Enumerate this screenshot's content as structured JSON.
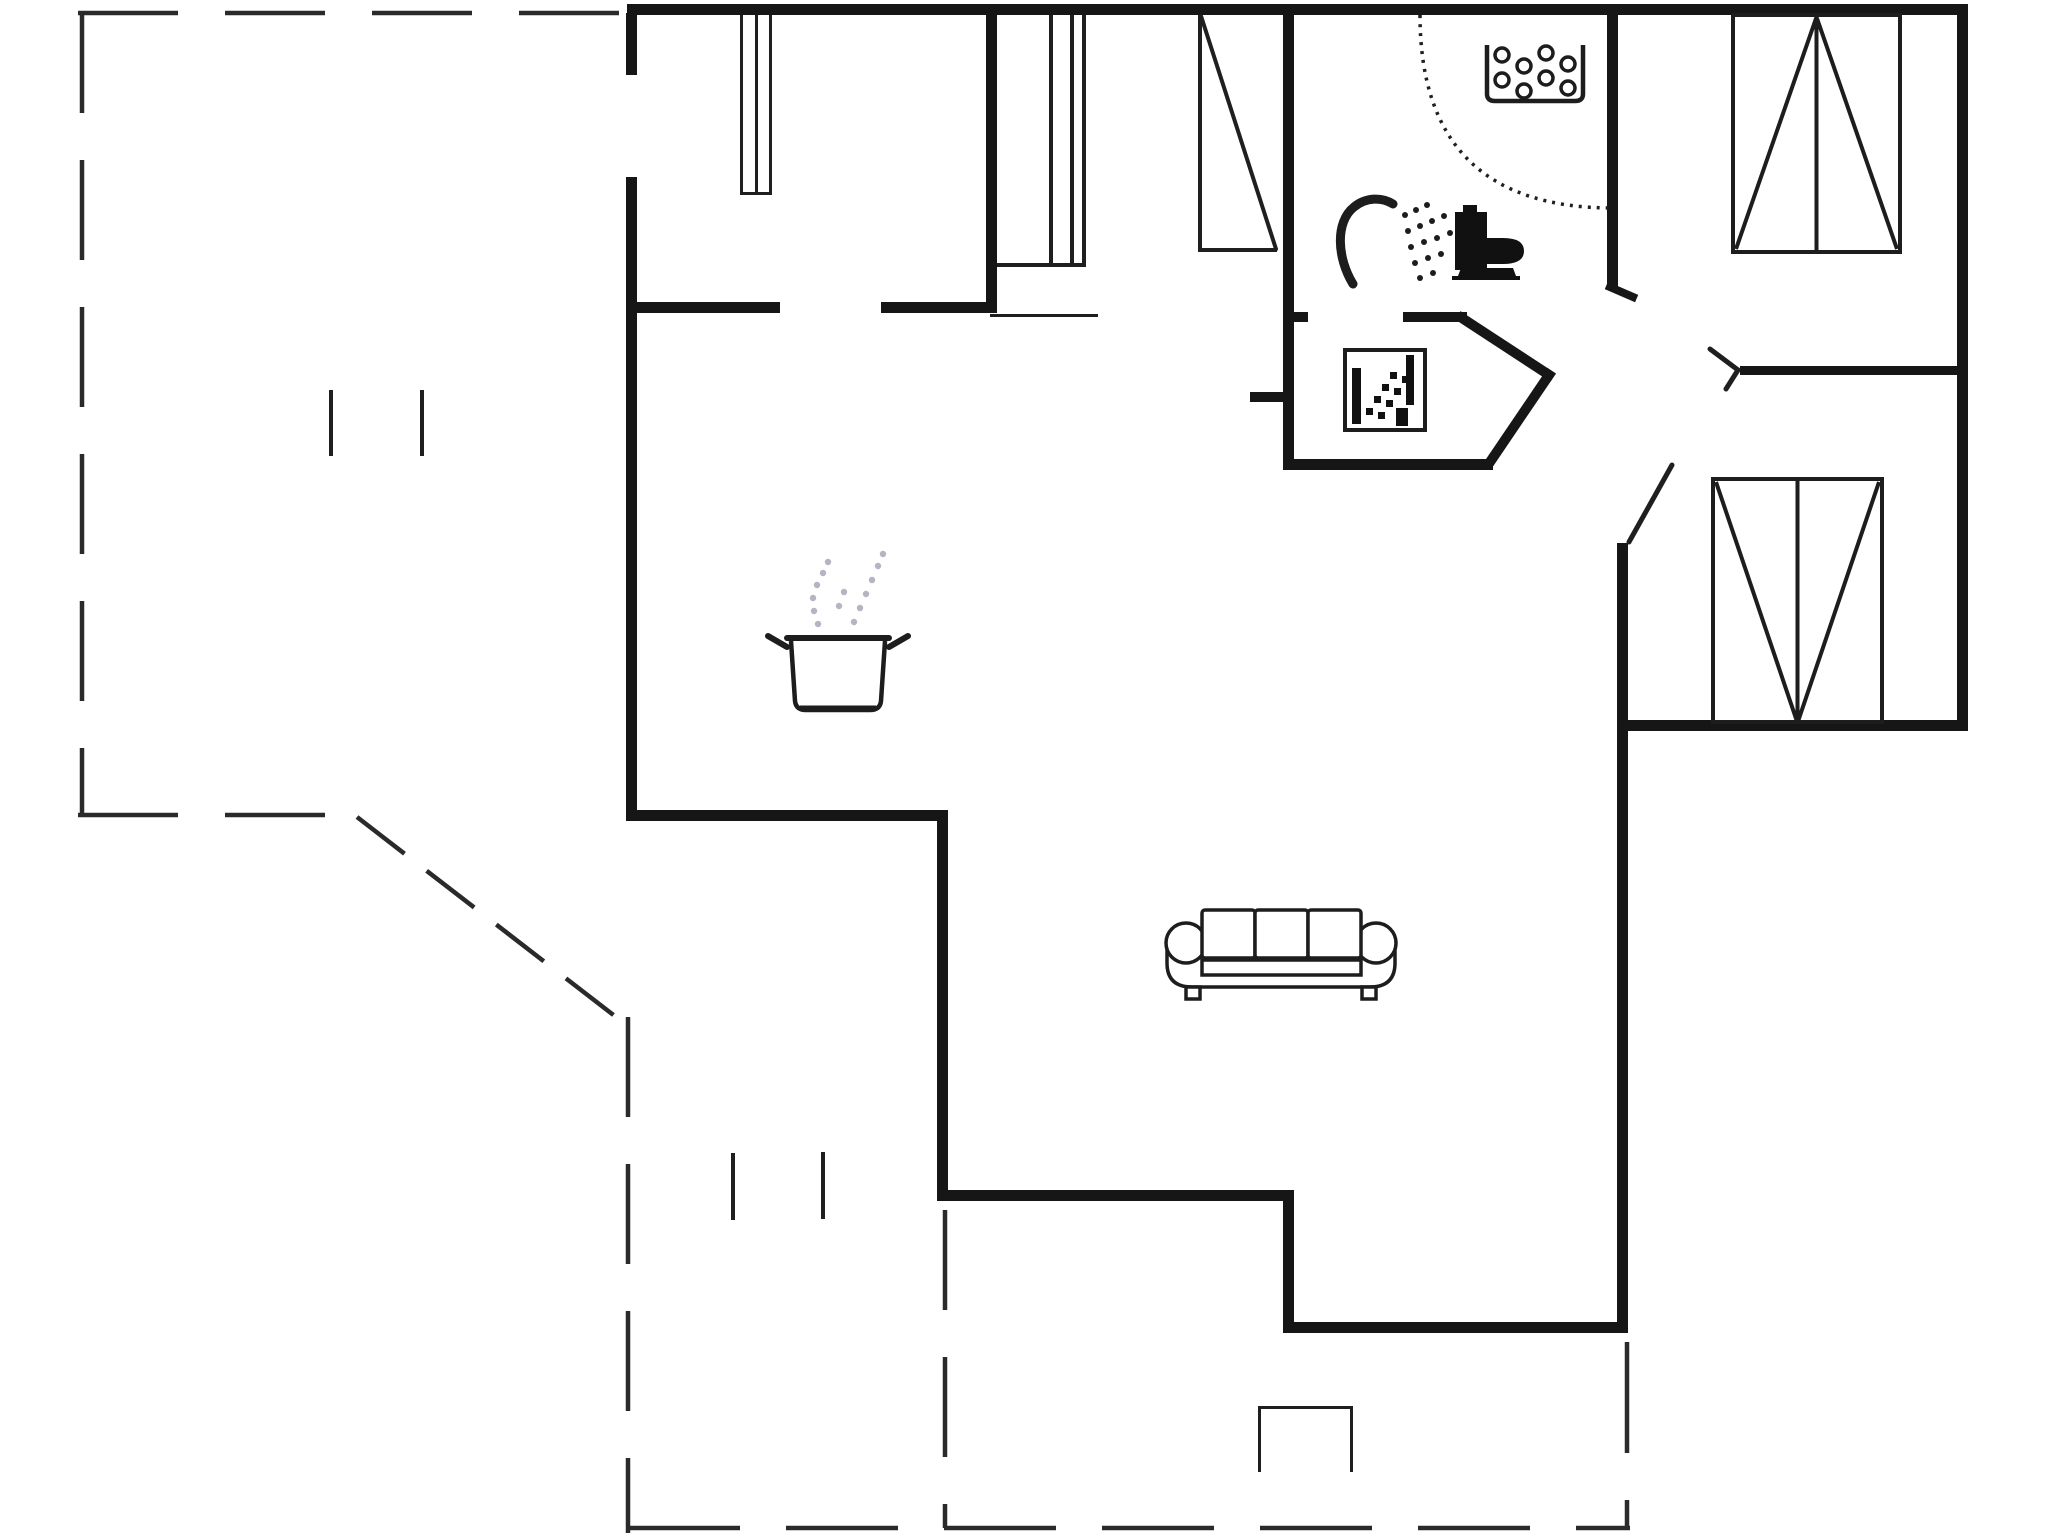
{
  "meta": {
    "title": "holiday-house-floor-plan",
    "canvas": {
      "w": 2048,
      "h": 1536
    },
    "colors": {
      "background": "#ffffff",
      "wall": "#161616",
      "thin": "#1f1f1f",
      "dash": "#2a2a2a",
      "icon": "#1d1d1d",
      "fill_black": "#111111",
      "steam": "#b4b4c2"
    }
  },
  "plan": {
    "walls": [
      [
        627,
        4,
        1341,
        11,
        "top-exterior-wall"
      ],
      [
        1957,
        4,
        11,
        727,
        "right-exterior-wall"
      ],
      [
        1627,
        720,
        341,
        11,
        "bedroom2-bottom-exterior-wall"
      ],
      [
        1617,
        543,
        11,
        790,
        "living-right-exterior-wall"
      ],
      [
        1283,
        1322,
        345,
        11,
        "living-bottom-exterior-wall"
      ],
      [
        1283,
        1196,
        11,
        137,
        "living-left-lower-exterior-wall"
      ],
      [
        948,
        1190,
        346,
        11,
        "living-bottomleft-exterior-wall"
      ],
      [
        937,
        816,
        11,
        385,
        "living-left-exterior-wall"
      ],
      [
        626,
        810,
        322,
        11,
        "kitchen-bottom-exterior-wall"
      ],
      [
        626,
        177,
        11,
        644,
        "kitchen-left-exterior-wall"
      ],
      [
        626,
        13,
        11,
        62,
        "kitchen-left-wall-stub"
      ],
      [
        637,
        302,
        143,
        11,
        "kitchen-partition-wall-left"
      ],
      [
        881,
        302,
        109,
        11,
        "kitchen-partition-wall-right"
      ],
      [
        986,
        13,
        11,
        300,
        "entry-partition-wall"
      ],
      [
        1283,
        13,
        11,
        457,
        "bathroom-left-wall"
      ],
      [
        1283,
        459,
        210,
        11,
        "bathroom-bottom-wall"
      ],
      [
        1607,
        13,
        11,
        275,
        "bathroom-right-wall"
      ],
      [
        1403,
        312,
        64,
        10,
        "bathroom-door-stub"
      ],
      [
        1288,
        312,
        20,
        10,
        "hall-niche-stub-upper"
      ],
      [
        1250,
        392,
        33,
        10,
        "hall-niche-stub-lower"
      ],
      [
        1740,
        366,
        217,
        9,
        "bedroom-divider-wall"
      ]
    ],
    "wall_diagonals": [
      [
        1462,
        318,
        1549,
        375,
        10,
        "hall-chamfer-wall-upper"
      ],
      [
        1549,
        375,
        1490,
        462,
        10,
        "hall-chamfer-wall-lower"
      ],
      [
        1610,
        287,
        1633,
        297,
        8,
        "bathroom-right-wall-end-stub"
      ]
    ],
    "thin_rects": [
      [
        1198,
        15,
        4,
        237,
        "entrance-door-edge"
      ],
      [
        1199,
        248,
        78,
        4,
        "entrance-door-bottom"
      ],
      [
        997,
        263,
        89,
        4,
        "entry-cupboard-bottom"
      ],
      [
        1082,
        15,
        4,
        252,
        "entry-cupboard-right"
      ],
      [
        1049,
        15,
        4,
        252,
        "entry-cupboard-inner-a"
      ],
      [
        1070,
        15,
        4,
        252,
        "entry-cupboard-inner-b"
      ],
      [
        990,
        314,
        108,
        3,
        "entry-threshold-line"
      ],
      [
        740,
        15,
        3,
        179,
        "room-cupboard-left"
      ],
      [
        769,
        15,
        3,
        179,
        "room-cupboard-right"
      ],
      [
        755,
        15,
        3,
        179,
        "room-cupboard-mid"
      ],
      [
        740,
        192,
        32,
        3,
        "room-cupboard-bottom"
      ],
      [
        1258,
        1406,
        95,
        3,
        "terrace-step-top"
      ],
      [
        1258,
        1406,
        3,
        66,
        "terrace-step-left"
      ],
      [
        1350,
        1406,
        3,
        66,
        "terrace-step-right"
      ],
      [
        329,
        390,
        4,
        66,
        "terrace-post-a"
      ],
      [
        420,
        390,
        4,
        66,
        "terrace-post-b"
      ],
      [
        731,
        1153,
        4,
        67,
        "terrace-post-c"
      ],
      [
        821,
        1152,
        4,
        67,
        "terrace-post-d"
      ]
    ],
    "thin_lines": [
      [
        1201,
        16,
        1276,
        249,
        4,
        "entrance-door-leaf-diagonal"
      ],
      [
        1710,
        349,
        1738,
        370,
        5,
        "bedroom1-door-leaf-a"
      ],
      [
        1738,
        370,
        1726,
        389,
        5,
        "bedroom1-door-leaf-b"
      ],
      [
        1629,
        542,
        1672,
        465,
        5,
        "bedroom2-door-leaf"
      ]
    ],
    "dashed_lines": [
      [
        78,
        13,
        627,
        13,
        "terrace-boundary-top",
        "100 47"
      ],
      [
        82,
        13,
        82,
        815,
        "terrace-boundary-left",
        "100 47"
      ],
      [
        78,
        815,
        357,
        815,
        "terrace-boundary-bottomleft",
        "100 47"
      ],
      [
        357,
        817,
        616,
        1017,
        "terrace-boundary-diagonal",
        "60 28"
      ],
      [
        628,
        1017,
        628,
        1533,
        "terrace-boundary-left-lower",
        "100 47"
      ],
      [
        628,
        1528,
        1630,
        1528,
        "terrace-boundary-bottom",
        "112 46"
      ],
      [
        1627,
        1342,
        1627,
        1530,
        "terrace-boundary-right",
        "111 47"
      ],
      [
        945,
        1210,
        945,
        1528,
        "terrace-divider-dash",
        "100 47"
      ]
    ],
    "arcs": [
      {
        "d": "M 1420 15 Q 1420 208 1613 208",
        "dash": "3 6",
        "w": 3.5,
        "name": "bathroom-door-swing-arc"
      }
    ],
    "icons": {
      "pot": {
        "x": 787,
        "y": 632
      },
      "sofa": {
        "x": 1166,
        "y": 908
      },
      "toilet": {
        "x": 1452,
        "y": 205
      },
      "shower": {
        "x": 1337,
        "y": 197
      },
      "spa": {
        "x": 1487,
        "y": 42
      },
      "washbasin": {
        "x": 1345,
        "y": 350
      },
      "wardrobe1": {
        "x": 1733,
        "y": 15,
        "w": 167,
        "h": 237,
        "apex": "top"
      },
      "wardrobe2": {
        "x": 1713,
        "y": 479,
        "w": 169,
        "h": 243,
        "apex": "bottom"
      }
    }
  }
}
